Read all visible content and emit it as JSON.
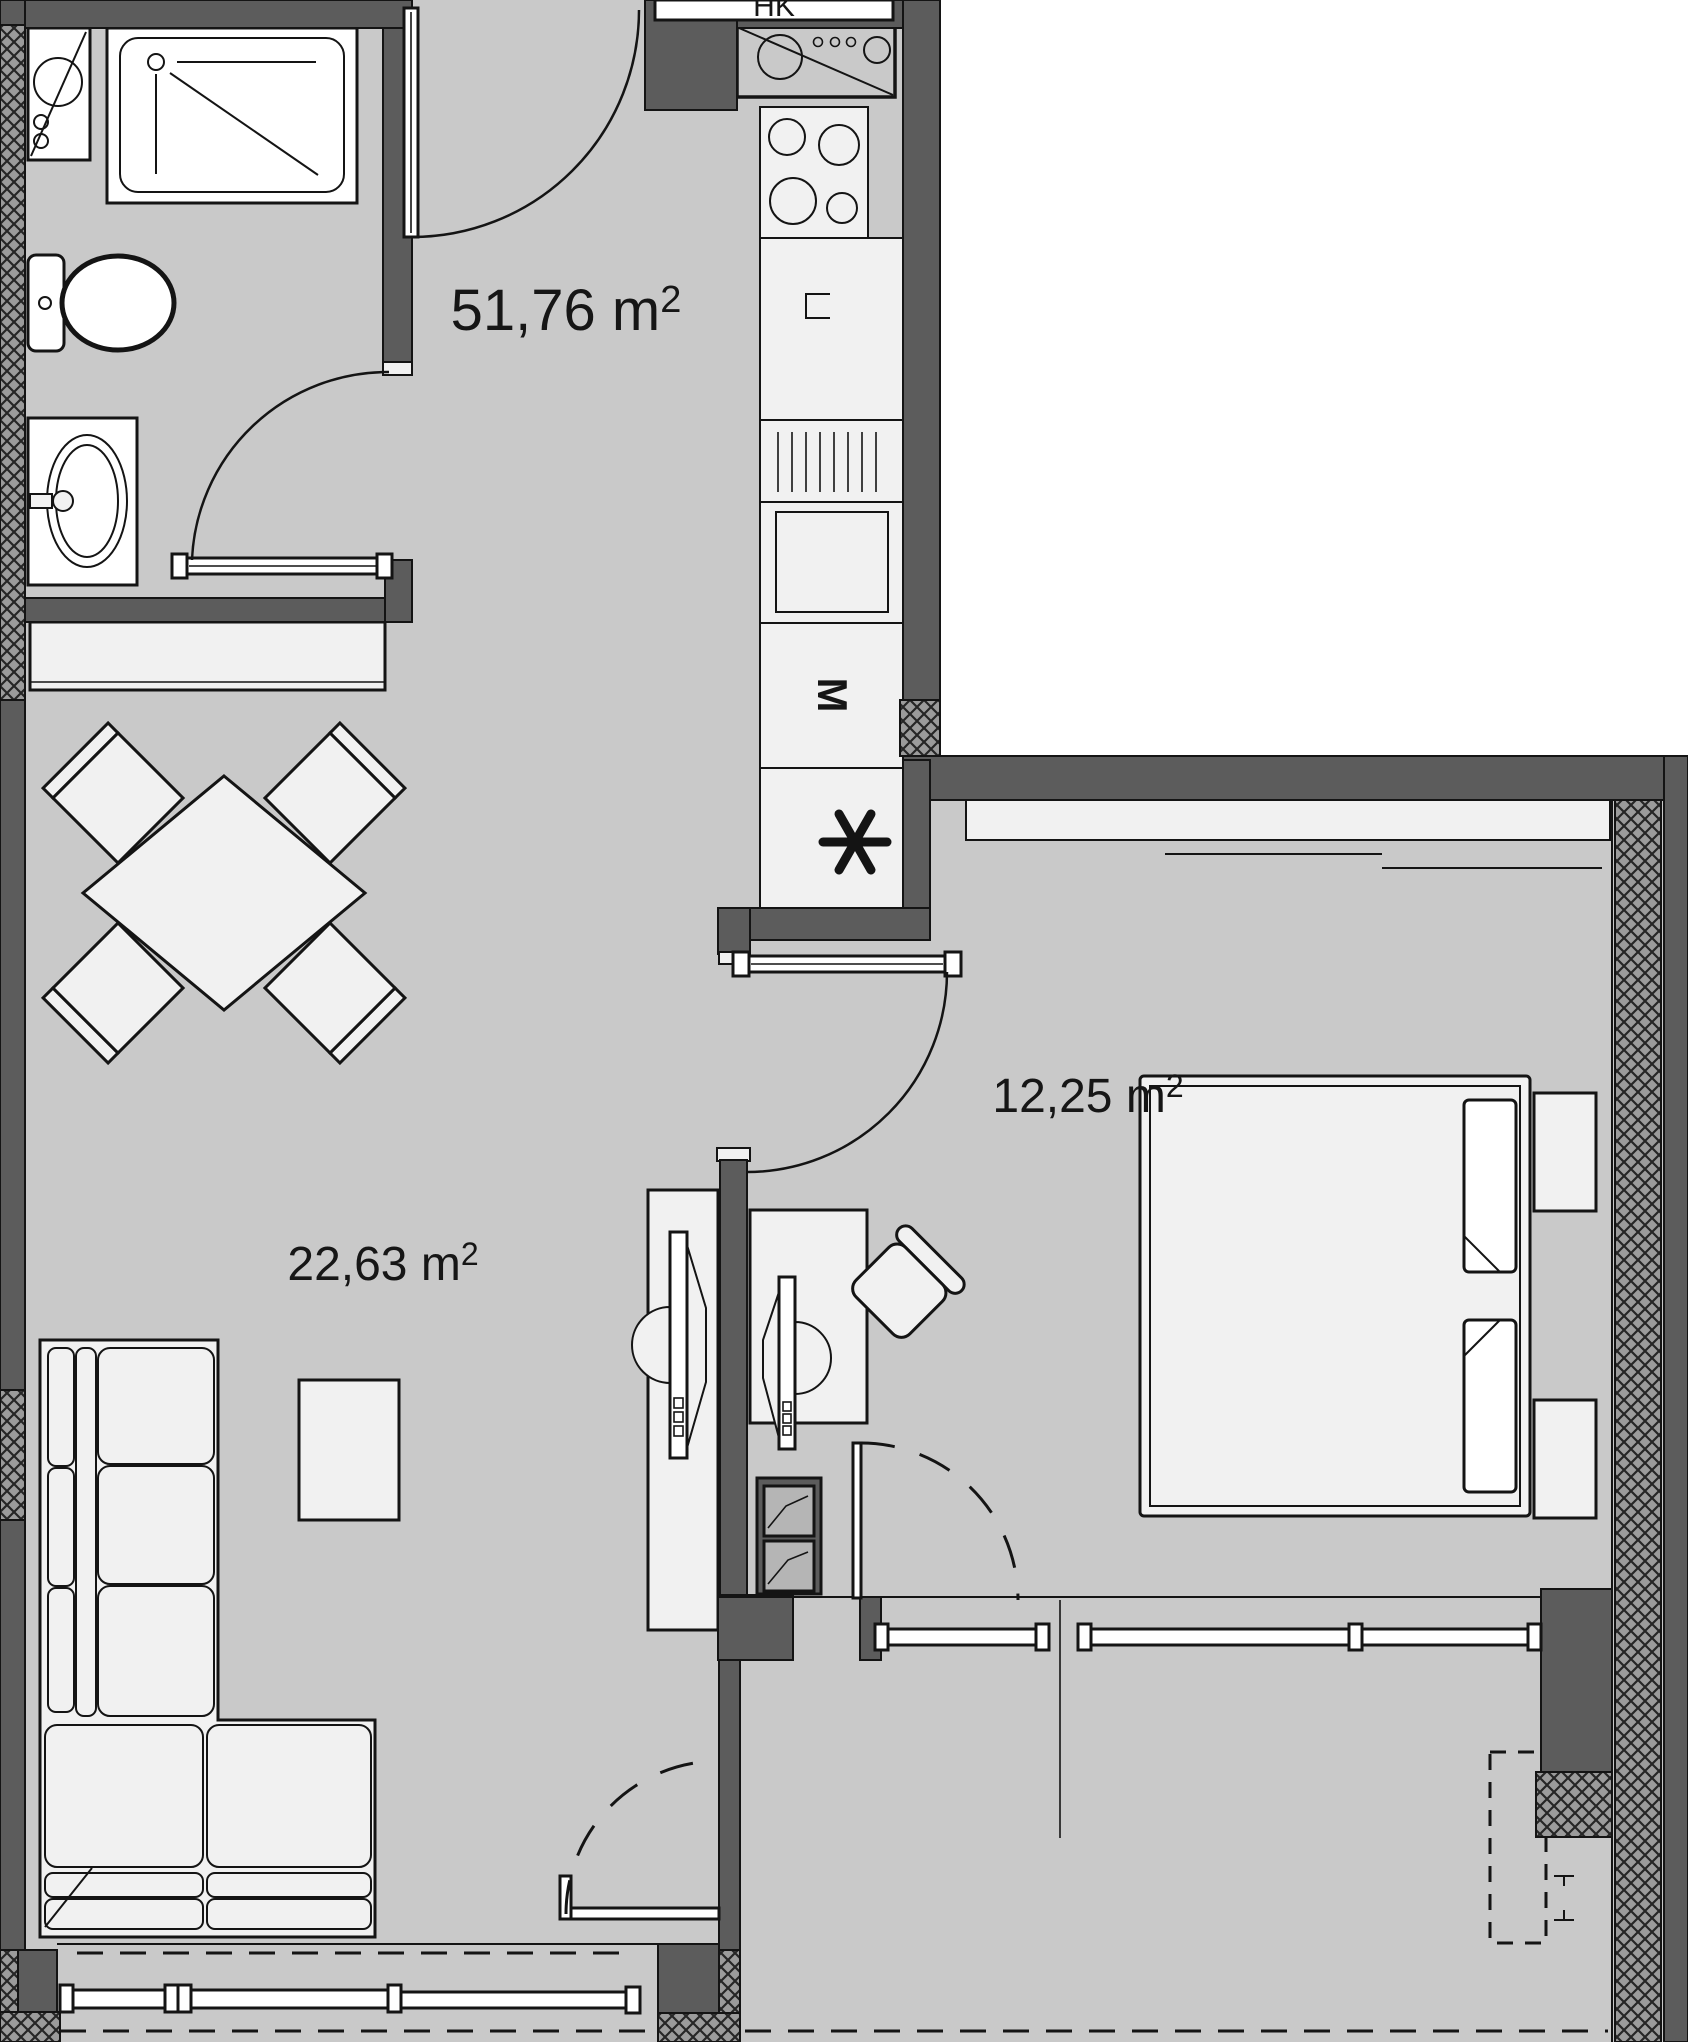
{
  "theme": {
    "floor": "#c9c9c9",
    "wall": "#5c5c5c",
    "furniture": "#f1f1f1",
    "line": "#141414",
    "hatch": "#9b9b9b",
    "outside": "#ffffff"
  },
  "labels": {
    "total_area": {
      "value": "51,76",
      "unit": " m",
      "sup": "2"
    },
    "living_area": {
      "value": "22,63",
      "unit": " m",
      "sup": "2"
    },
    "bedroom_area": {
      "value": "12,25",
      "unit": " m",
      "sup": "2"
    },
    "shaft": "HK",
    "microwave": "M"
  }
}
